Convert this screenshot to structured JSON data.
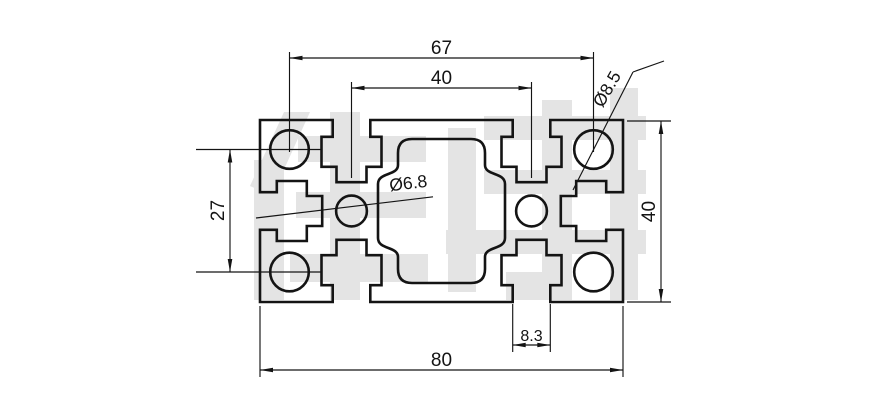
{
  "drawing": {
    "title": "aluminum-extrusion-profile-cross-section",
    "dims": {
      "top_outer": "67",
      "top_inner": "40",
      "corner_hole": "Ø8.5",
      "left_height": "27",
      "right_height": "40",
      "slot_width": "8.3",
      "bottom_width": "80",
      "center_hole": "Ø6.8"
    },
    "colors": {
      "line": "#141414",
      "watermark": "#e4e4e4",
      "background": "#ffffff"
    },
    "watermark": {
      "description": "large light-gray logo characters behind the drawing (illegible)"
    }
  }
}
